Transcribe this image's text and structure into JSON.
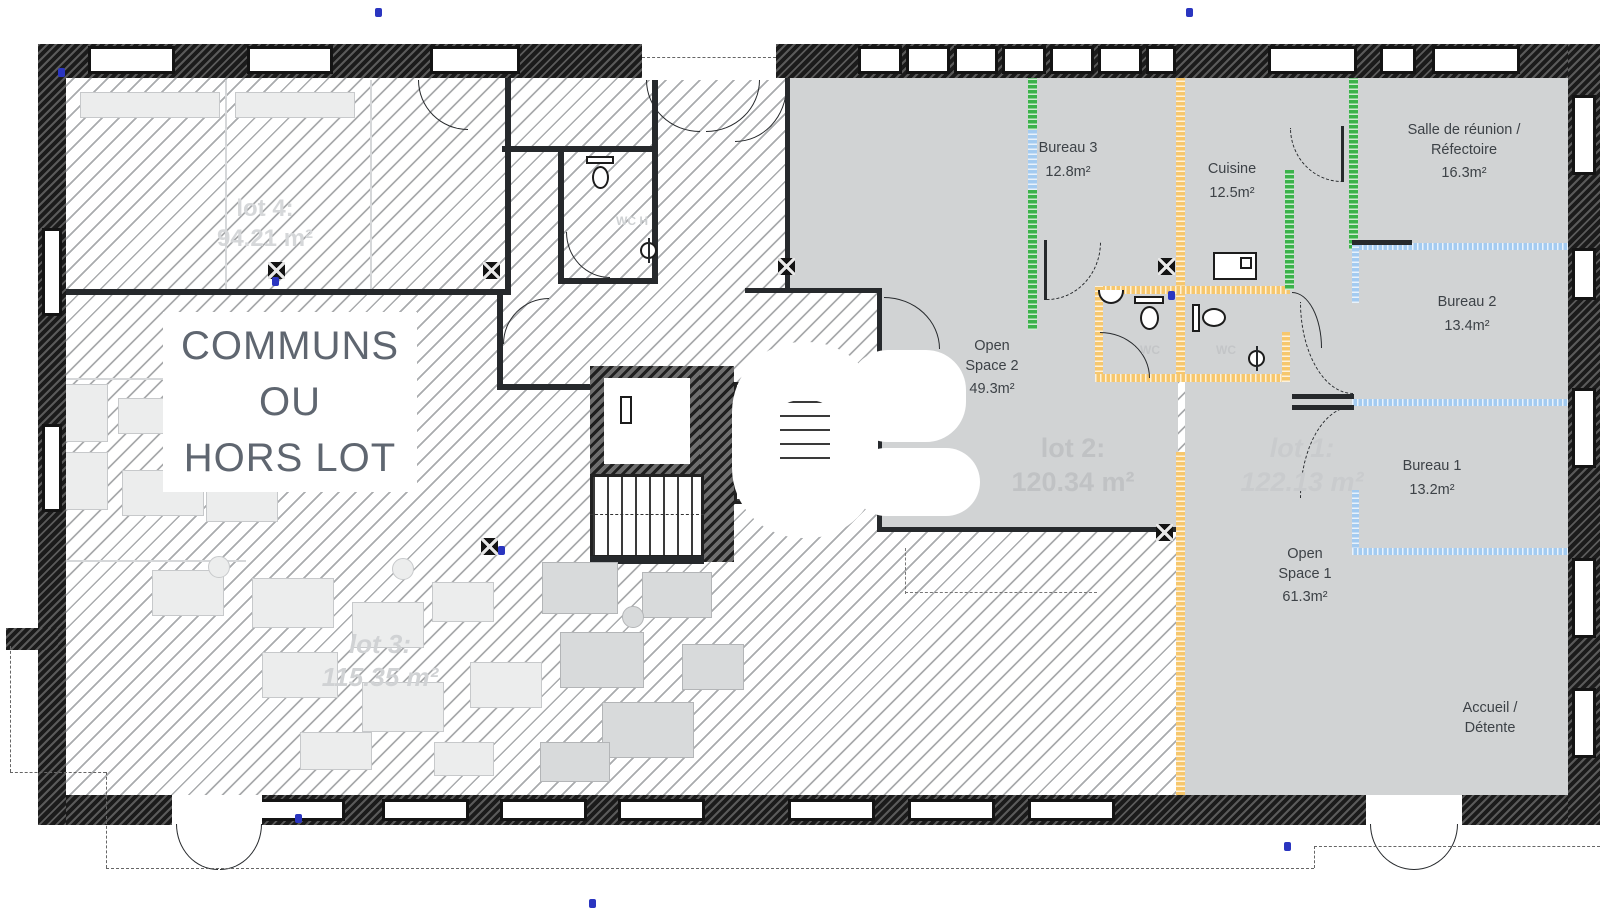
{
  "plan": {
    "communs": {
      "line1": "COMMUNS",
      "line2": "OU",
      "line3": "HORS LOT"
    },
    "rooms": {
      "bureau3": {
        "name": "Bureau 3",
        "area": "12.8m²"
      },
      "cuisine": {
        "name": "Cuisine",
        "area": "12.5m²"
      },
      "salle_reunion": {
        "name": "Salle de réunion /",
        "name2": "Réfectoire",
        "area": "16.3m²"
      },
      "bureau2": {
        "name": "Bureau 2",
        "area": "13.4m²"
      },
      "bureau1": {
        "name": "Bureau 1",
        "area": "13.2m²"
      },
      "open_space2": {
        "name": "Open",
        "name2": "Space 2",
        "area": "49.3m²"
      },
      "open_space1": {
        "name": "Open",
        "name2": "Space 1",
        "area": "61.3m²"
      },
      "accueil": {
        "name": "Accueil /",
        "name2": "Détente"
      },
      "wc_left": "WC",
      "wc_right": "WC",
      "wc_h": "WC H"
    },
    "lots": {
      "lot1": {
        "label": "lot 1:",
        "area": "122.13 m²"
      },
      "lot2": {
        "label": "lot 2:",
        "area": "120.34 m²"
      },
      "lot3": {
        "label": "lot 3:",
        "area": "115.35 m²"
      },
      "lot4": {
        "label": "lot 4:",
        "area": "94.21 m²"
      }
    },
    "colors": {
      "partition_green": "#3bb24a",
      "partition_blue": "#a4cbf0",
      "partition_yellow": "#f6c76d",
      "lot_fill_gray": "#d1d3d4"
    }
  }
}
